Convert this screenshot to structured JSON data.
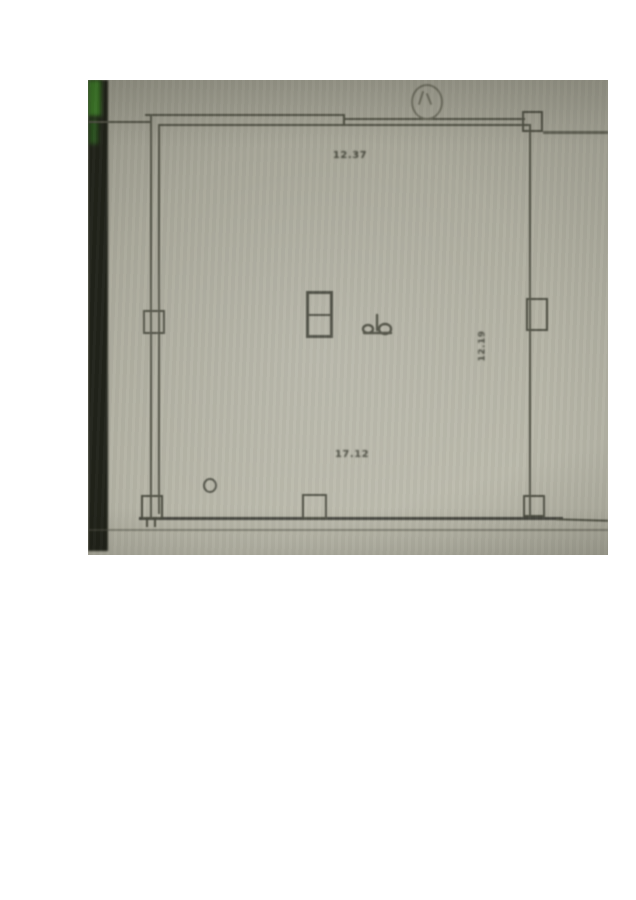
{
  "photo": {
    "description": "photograph of a hand-drafted floor plan on olive-grey paper",
    "paper_color": "#b0afa2",
    "line_color": "#535447",
    "dark_edge_color": "#21231a",
    "green_accent_color": "#3e7c2a"
  },
  "plan": {
    "labels": {
      "top_dimension": "12.37",
      "bottom_dimension": "17.12",
      "right_dimension": "12.19"
    },
    "symbols": {
      "north_circle": "north-circle-symbol",
      "center_shaft": "double-cell column/shaft",
      "fixture_mark": "small handwritten mark",
      "small_ring": "small circle mark"
    }
  }
}
